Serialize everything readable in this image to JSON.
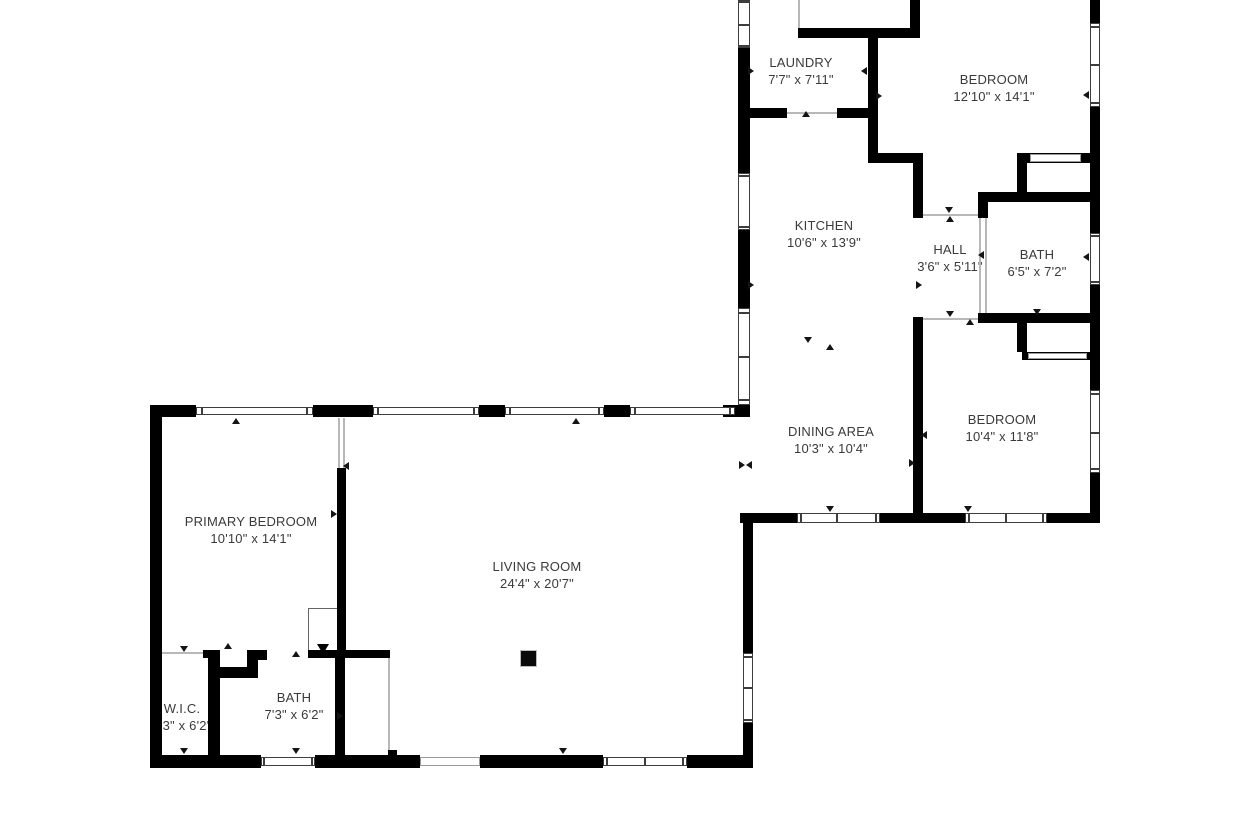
{
  "meta": {
    "type": "floor-plan",
    "background": "#ffffff",
    "wall_color": "#000000",
    "text_color": "#3a3a3a"
  },
  "rooms": [
    {
      "id": "laundry",
      "name": "LAUNDRY",
      "dims": "7'7\" x 7'11\"",
      "x": 801,
      "y": 54
    },
    {
      "id": "bedroom-1",
      "name": "BEDROOM",
      "dims": "12'10\" x 14'1\"",
      "x": 994,
      "y": 71
    },
    {
      "id": "kitchen",
      "name": "KITCHEN",
      "dims": "10'6\" x 13'9\"",
      "x": 824,
      "y": 217
    },
    {
      "id": "hall",
      "name": "HALL",
      "dims": "3'6\" x 5'11\"",
      "x": 950,
      "y": 241
    },
    {
      "id": "bath-1",
      "name": "BATH",
      "dims": "6'5\" x 7'2\"",
      "x": 1037,
      "y": 246
    },
    {
      "id": "dining-area",
      "name": "DINING AREA",
      "dims": "10'3\" x 10'4\"",
      "x": 831,
      "y": 423
    },
    {
      "id": "bedroom-2",
      "name": "BEDROOM",
      "dims": "10'4\" x 11'8\"",
      "x": 1002,
      "y": 411
    },
    {
      "id": "primary-bedroom",
      "name": "PRIMARY BEDROOM",
      "dims": "10'10\" x 14'1\"",
      "x": 251,
      "y": 513
    },
    {
      "id": "living-room",
      "name": "LIVING ROOM",
      "dims": "24'4\" x 20'7\"",
      "x": 537,
      "y": 558
    },
    {
      "id": "wic",
      "name": "W.I.C.",
      "dims": "3'3\" x 6'2\"",
      "x": 182,
      "y": 700
    },
    {
      "id": "bath-2",
      "name": "BATH",
      "dims": "7'3\" x 6'2\"",
      "x": 294,
      "y": 689
    }
  ],
  "geometry": {
    "walls": [
      [
        738,
        48,
        12,
        125
      ],
      [
        738,
        230,
        12,
        78
      ],
      [
        738,
        400,
        12,
        17
      ],
      [
        723,
        405,
        25,
        12
      ],
      [
        798,
        28,
        122,
        10
      ],
      [
        910,
        0,
        10,
        38
      ],
      [
        868,
        37,
        10,
        126
      ],
      [
        868,
        153,
        55,
        10
      ],
      [
        744,
        108,
        43,
        10
      ],
      [
        837,
        108,
        41,
        10
      ],
      [
        913,
        163,
        10,
        55
      ],
      [
        913,
        317,
        10,
        196
      ],
      [
        1017,
        153,
        83,
        10
      ],
      [
        1017,
        163,
        10,
        39
      ],
      [
        985,
        192,
        115,
        10
      ],
      [
        978,
        192,
        10,
        26
      ],
      [
        978,
        313,
        122,
        10
      ],
      [
        1017,
        323,
        10,
        29
      ],
      [
        1022,
        352,
        71,
        8
      ],
      [
        1090,
        0,
        10,
        23
      ],
      [
        1090,
        107,
        10,
        126
      ],
      [
        1090,
        285,
        10,
        105
      ],
      [
        1090,
        473,
        10,
        50
      ],
      [
        740,
        513,
        57,
        10
      ],
      [
        880,
        513,
        85,
        10
      ],
      [
        1047,
        513,
        53,
        10
      ],
      [
        150,
        405,
        12,
        363
      ],
      [
        150,
        405,
        46,
        12
      ],
      [
        313,
        405,
        60,
        12
      ],
      [
        479,
        405,
        26,
        12
      ],
      [
        604,
        405,
        26,
        12
      ],
      [
        337,
        468,
        9,
        190
      ],
      [
        203,
        650,
        17,
        8
      ],
      [
        208,
        650,
        12,
        108
      ],
      [
        247,
        650,
        20,
        10
      ],
      [
        308,
        650,
        82,
        8
      ],
      [
        247,
        660,
        11,
        18
      ],
      [
        220,
        667,
        38,
        11
      ],
      [
        335,
        658,
        10,
        100
      ],
      [
        150,
        755,
        111,
        13
      ],
      [
        315,
        755,
        105,
        13
      ],
      [
        480,
        755,
        123,
        13
      ],
      [
        687,
        755,
        66,
        13
      ],
      [
        743,
        513,
        10,
        140
      ],
      [
        743,
        723,
        10,
        45
      ],
      [
        388,
        750,
        9,
        8
      ]
    ],
    "windows": [
      {
        "x": 738,
        "y": 0,
        "w": 12,
        "h": 48,
        "o": "v",
        "d": [
          0.52
        ]
      },
      {
        "x": 738,
        "y": 173,
        "w": 12,
        "h": 57,
        "o": "v",
        "d": []
      },
      {
        "x": 738,
        "y": 308,
        "w": 12,
        "h": 97,
        "o": "v",
        "d": [
          0.5
        ]
      },
      {
        "x": 1090,
        "y": 23,
        "w": 10,
        "h": 84,
        "o": "v",
        "d": [
          0.5
        ]
      },
      {
        "x": 1090,
        "y": 233,
        "w": 10,
        "h": 52,
        "o": "v",
        "d": []
      },
      {
        "x": 1090,
        "y": 390,
        "w": 10,
        "h": 83,
        "o": "v",
        "d": [
          0.52
        ]
      },
      {
        "x": 797,
        "y": 513,
        "w": 83,
        "h": 10,
        "o": "h",
        "d": [
          0.48
        ]
      },
      {
        "x": 965,
        "y": 513,
        "w": 82,
        "h": 10,
        "o": "h",
        "d": [
          0.5
        ]
      },
      {
        "x": 196,
        "y": 407,
        "w": 117,
        "h": 8,
        "o": "h",
        "d": []
      },
      {
        "x": 373,
        "y": 407,
        "w": 106,
        "h": 8,
        "o": "h",
        "d": []
      },
      {
        "x": 505,
        "y": 407,
        "w": 99,
        "h": 8,
        "o": "h",
        "d": []
      },
      {
        "x": 630,
        "y": 407,
        "w": 105,
        "h": 8,
        "o": "h",
        "d": []
      },
      {
        "x": 261,
        "y": 757,
        "w": 54,
        "h": 9,
        "o": "h",
        "d": []
      },
      {
        "x": 603,
        "y": 757,
        "w": 84,
        "h": 9,
        "o": "h",
        "d": [
          0.5
        ]
      },
      {
        "x": 743,
        "y": 653,
        "w": 10,
        "h": 70,
        "o": "v",
        "d": [
          0.5
        ]
      },
      {
        "x": 420,
        "y": 757,
        "w": 60,
        "h": 9,
        "o": "h",
        "d": [],
        "s": "slider"
      },
      {
        "x": 1030,
        "y": 154,
        "w": 51,
        "h": 8,
        "o": "h",
        "d": [],
        "s": "slider"
      },
      {
        "x": 1028,
        "y": 353,
        "w": 59,
        "h": 6,
        "o": "h",
        "d": [],
        "s": "slider"
      }
    ],
    "thin_lines": [
      [
        798,
        0,
        2,
        28
      ],
      [
        787,
        112,
        50,
        2
      ],
      [
        923,
        214,
        55,
        2
      ],
      [
        923,
        318,
        55,
        2
      ],
      [
        979,
        218,
        2,
        95
      ],
      [
        985,
        218,
        2,
        95
      ],
      [
        338,
        418,
        2,
        50
      ],
      [
        343,
        418,
        2,
        50
      ],
      [
        162,
        652,
        46,
        2
      ],
      [
        388,
        658,
        2,
        92
      ]
    ],
    "markers": [
      [
        806,
        114,
        "up"
      ],
      [
        864,
        71,
        "left"
      ],
      [
        879,
        96,
        "right"
      ],
      [
        751,
        71,
        "right"
      ],
      [
        751,
        285,
        "right"
      ],
      [
        949,
        210,
        "down"
      ],
      [
        950,
        219,
        "up"
      ],
      [
        919,
        285,
        "right"
      ],
      [
        981,
        255,
        "left"
      ],
      [
        950,
        314,
        "down"
      ],
      [
        970,
        322,
        "up"
      ],
      [
        1037,
        312,
        "down"
      ],
      [
        1086,
        95,
        "left"
      ],
      [
        1086,
        257,
        "left"
      ],
      [
        808,
        340,
        "down"
      ],
      [
        830,
        347,
        "up"
      ],
      [
        924,
        435,
        "left"
      ],
      [
        912,
        463,
        "right"
      ],
      [
        742,
        465,
        "right"
      ],
      [
        749,
        465,
        "left"
      ],
      [
        830,
        509,
        "down"
      ],
      [
        968,
        509,
        "down"
      ],
      [
        236,
        421,
        "up"
      ],
      [
        576,
        421,
        "up"
      ],
      [
        346,
        466,
        "left"
      ],
      [
        334,
        514,
        "right"
      ],
      [
        184,
        649,
        "down"
      ],
      [
        228,
        646,
        "up"
      ],
      [
        296,
        654,
        "up"
      ],
      [
        340,
        716,
        "right"
      ],
      [
        184,
        751,
        "down"
      ],
      [
        296,
        751,
        "down"
      ],
      [
        563,
        751,
        "down"
      ]
    ],
    "stairs": {
      "x": 308,
      "y": 608,
      "w": 30,
      "h": 44,
      "treads": 3
    },
    "column": {
      "x": 520,
      "y": 650,
      "s": 15
    }
  }
}
